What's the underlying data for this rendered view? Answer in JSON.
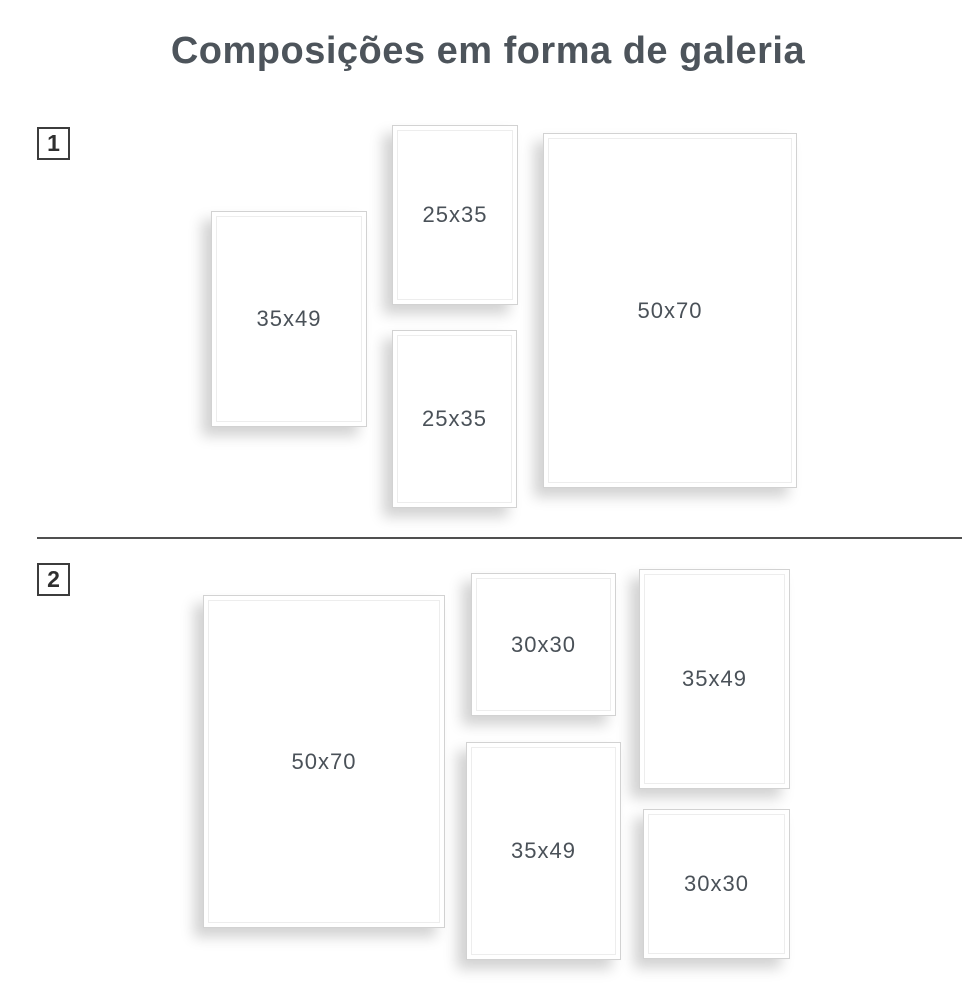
{
  "title": "Composições em forma de galeria",
  "sections": [
    {
      "number": "1",
      "frames": [
        {
          "label": "35x49"
        },
        {
          "label": "25x35"
        },
        {
          "label": "25x35"
        },
        {
          "label": "50x70"
        }
      ]
    },
    {
      "number": "2",
      "frames": [
        {
          "label": "50x70"
        },
        {
          "label": "30x30"
        },
        {
          "label": "35x49"
        },
        {
          "label": "35x49"
        },
        {
          "label": "30x30"
        }
      ]
    }
  ],
  "colors": {
    "background": "#ffffff",
    "title_text": "#4d545b",
    "label_text": "#4a5158",
    "marker_border": "#3c3c3c",
    "frame_border": "#d2d2d2",
    "divider": "#505050"
  }
}
